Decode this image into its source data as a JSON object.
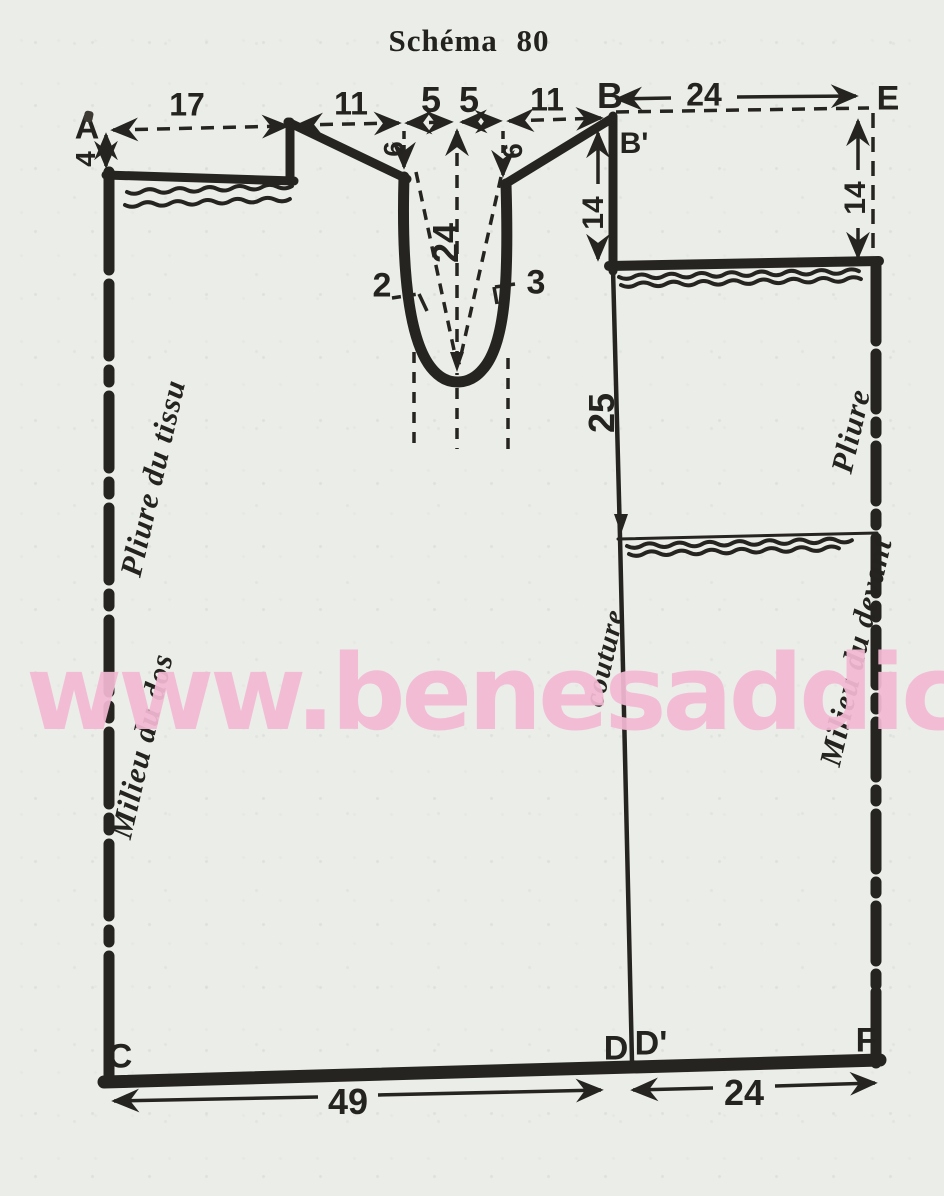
{
  "title": "Schéma 80",
  "watermark": "www.benesaddict.fr",
  "points": {
    "A": "A",
    "B": "B",
    "B_prime": "B'",
    "C": "C",
    "D": "D",
    "D_prime": "D'",
    "E": "E",
    "F": "F"
  },
  "measurements": {
    "back_neck_to_A": "17",
    "shoulder_left": "11",
    "neck_half_left": "5",
    "neck_half_right": "5",
    "shoulder_right": "11",
    "front_top_width": "24",
    "a_drop": "4",
    "slit_side_left": "6",
    "slit_side_right": "6",
    "slit_depth": "24",
    "notch_left": "2",
    "notch_right": "3",
    "front_drop_left": "14",
    "front_drop_right": "14",
    "side_to_waist": "25",
    "bottom_back_width": "49",
    "bottom_front_width": "24"
  },
  "annotations": {
    "seam": "couture",
    "back_fold_top": "Pliure du tissu",
    "back_fold_bottom": "Milieu du dos",
    "front_fold_top": "Pliure",
    "front_fold_bottom": "Milieu du devant"
  },
  "colors": {
    "ink": "#262420",
    "paper": "#ebede8",
    "watermark": "#f4b9d4"
  }
}
